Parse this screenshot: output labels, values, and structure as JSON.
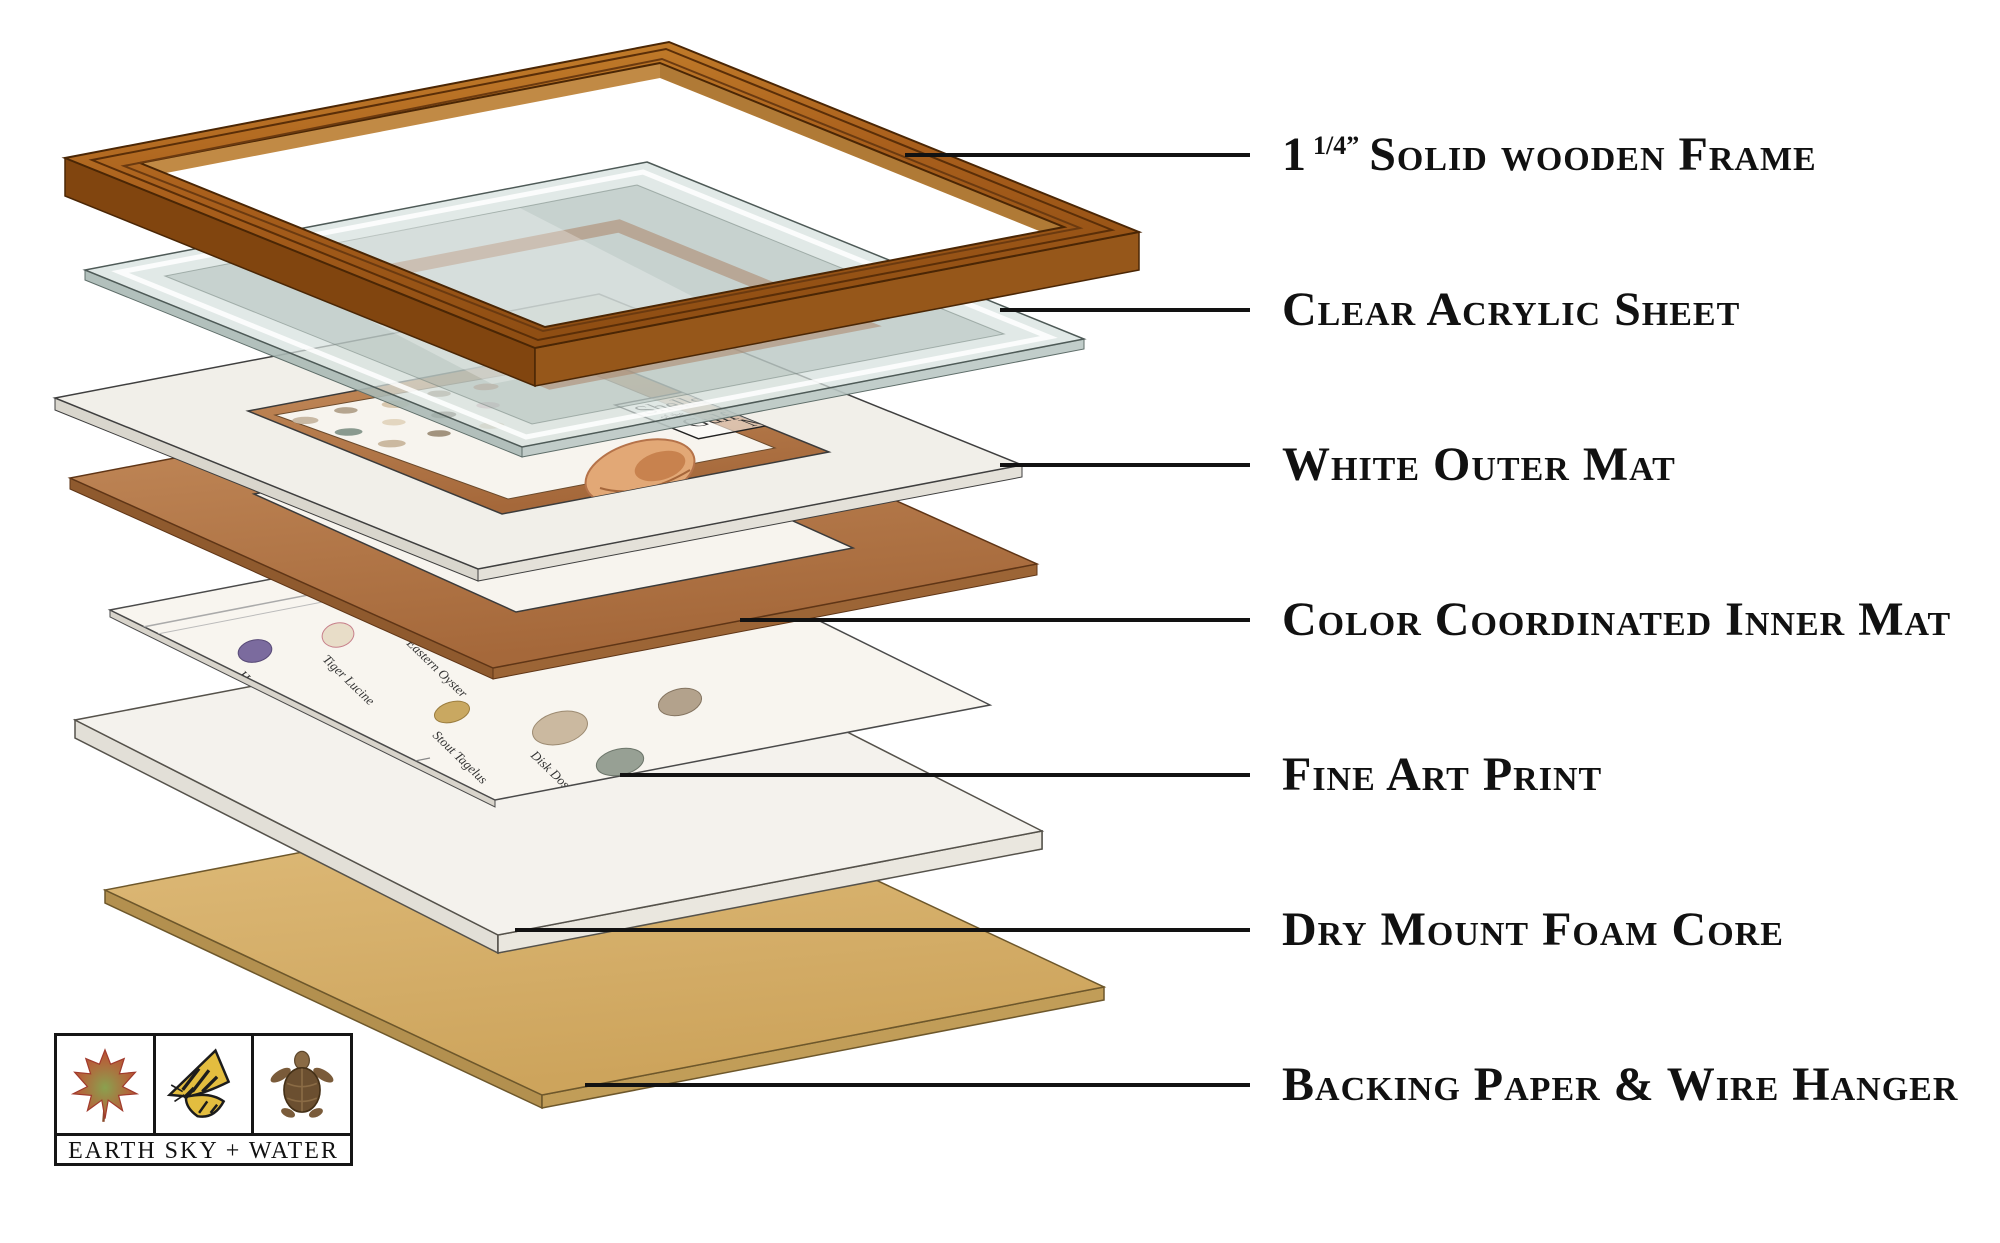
{
  "page": {
    "type": "Exploded diagram of framed art print construction"
  },
  "labels": [
    {
      "prefix": "1",
      "sup": "1/4”",
      "text": "Solid wooden Frame"
    },
    {
      "text": "Clear Acrylic Sheet"
    },
    {
      "text": "White Outer Mat"
    },
    {
      "text": "Color Coordinated Inner Mat"
    },
    {
      "text": "Fine Art Print"
    },
    {
      "text": "Dry Mount Foam Core"
    },
    {
      "text": "Backing Paper & Wire Hanger"
    }
  ],
  "print": {
    "title": {
      "word1": "Shells",
      "of1": "of the",
      "word2": "Gulf",
      "sub1": "and",
      "sub2": "Beach Life",
      "word3": "Mex"
    },
    "shell_names": [
      "Southern Quahog",
      "Hooked Mussel",
      "Tiger Lucine",
      "Eastern Oyster",
      "Sailor's Ear",
      "Stout Tagelus",
      "Disk Dosinia"
    ]
  },
  "logo": {
    "text": "EARTH SKY + WATER"
  },
  "colors": {
    "wood": "#a95f1c",
    "wood_highlight": "#c8842e",
    "copper_mat": "#b5794a",
    "backing_paper": "#d9b672",
    "acrylic": "#dde6e3",
    "outer_mat": "#f1efe9",
    "label_text": "#111111"
  }
}
